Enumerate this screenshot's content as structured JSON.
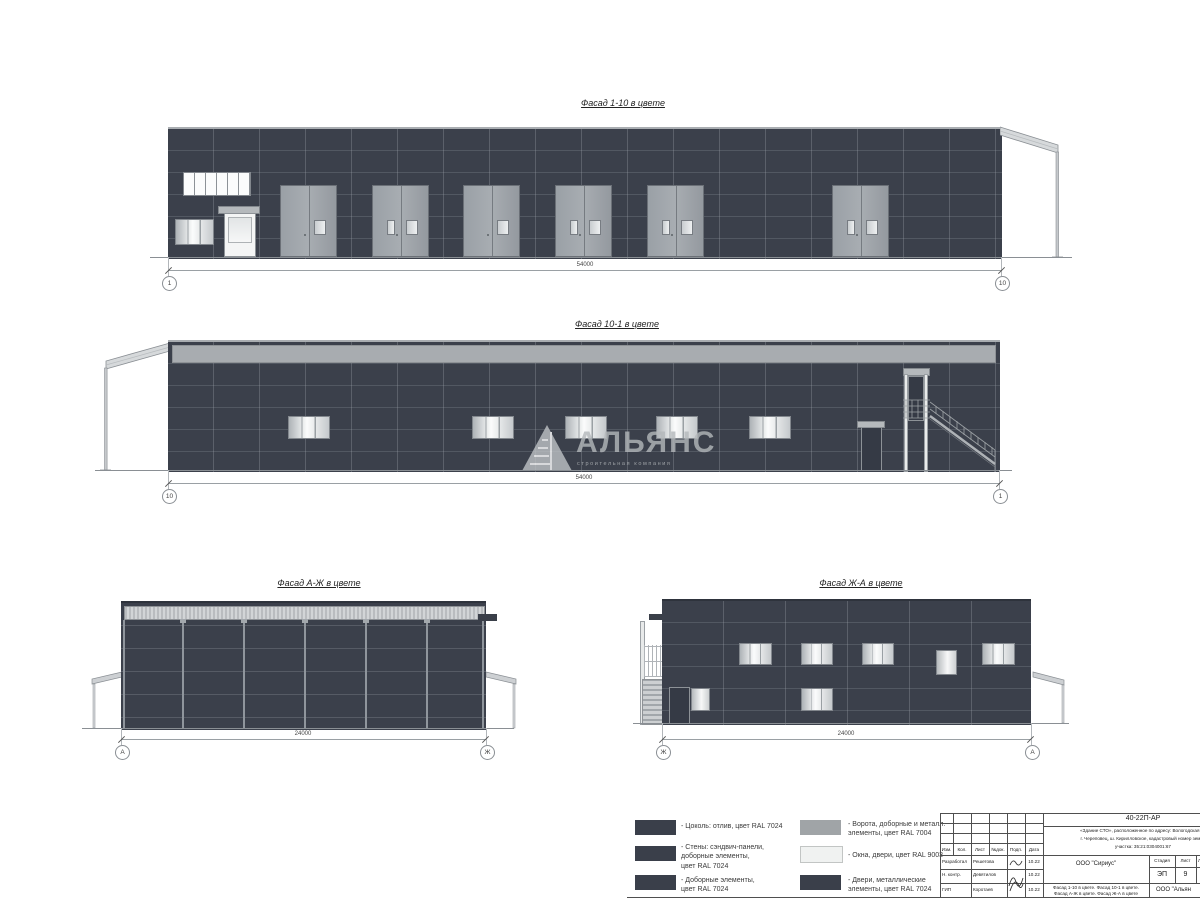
{
  "facades": {
    "f110": {
      "title": "Фасад 1-10 в цвете",
      "dim": "54000",
      "axis_left": "1",
      "axis_right": "10"
    },
    "f101": {
      "title": "Фасад 10-1 в цвете",
      "dim": "54000",
      "axis_left": "10",
      "axis_right": "1"
    },
    "faj": {
      "title": "Фасад А-Ж в цвете",
      "dim": "24000",
      "axis_left": "А",
      "axis_right": "Ж"
    },
    "fja": {
      "title": "Фасад Ж-А в цвете",
      "dim": "24000",
      "axis_left": "Ж",
      "axis_right": "А"
    }
  },
  "watermark": {
    "text": "АЛЬЯНС",
    "subtext": "строительная компания"
  },
  "legend": {
    "items": [
      {
        "color": "#3a3f4a",
        "label": "- Цоколь: отлив, цвет RAL 7024"
      },
      {
        "color": "#3a3f4a",
        "label": "- Стены: сэндвич-панели,\nдоборные элементы,\nцвет RAL 7024"
      },
      {
        "color": "#3a3f4a",
        "label": "- Доборные элементы,\nцвет RAL 7024"
      },
      {
        "color": "#a0a4a7",
        "label": "- Ворота, доборные и металл.\nэлементы, цвет RAL 7004"
      },
      {
        "color": "#f0f2f1",
        "label": "- Окна, двери, цвет RAL 9003"
      },
      {
        "color": "#3a3f4a",
        "label": "- Двери, металлические\nэлементы, цвет RAL 7024"
      }
    ]
  },
  "stamp": {
    "doc_number": "40-22П-АР",
    "address_line1": "«Здание СТО», расположенное по адресу: Вологодская об",
    "address_line2": "г. Череповец, ш. Кирилловское, кадастровый номер земел",
    "address_line3": "участка: 35:21:0304001:67",
    "header_cols": [
      "Изм.",
      "Кол.",
      "Лист",
      "№док.",
      "Подп.",
      "Дата"
    ],
    "rows": [
      {
        "role": "Разработал",
        "name": "Решетова",
        "date": "10.22"
      },
      {
        "role": "Н. контр.",
        "name": "Девятилов",
        "date": "10.22"
      },
      {
        "role": "ГИП",
        "name": "Коротаев",
        "date": "10.22"
      }
    ],
    "org1": "ООО \"Сириус\"",
    "stage_label": "Стадия",
    "sheet_label": "Лист",
    "sheets_label": "Л",
    "stage": "ЭП",
    "sheet": "9",
    "content_line1": "Фасад 1-10 в цвете. Фасад 10-1 в цвете.",
    "content_line2": "Фасад А-Ж в цвете. Фасад Ж-А в цвете",
    "org2": "ООО \"Альян"
  },
  "colors": {
    "wall": "#3b404b",
    "metal_gray_ral7004": "#a0a4a7",
    "white_ral9003": "#f0f2f1",
    "dark_ral7024": "#3a3f4a",
    "line": "#8a8f94"
  }
}
